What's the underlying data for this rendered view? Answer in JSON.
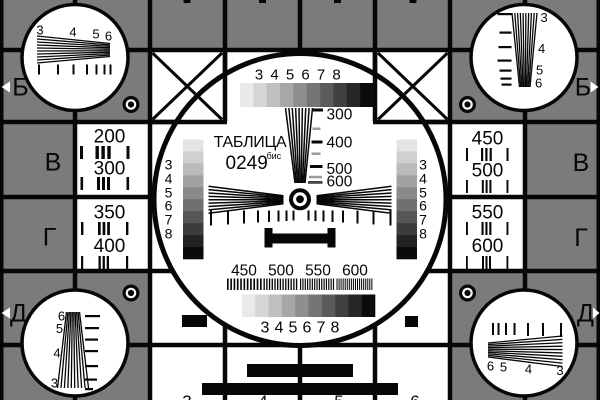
{
  "card": {
    "title": "ТАБЛИЦА",
    "code": "0249",
    "code_sup": "бис"
  },
  "center": {
    "top_scale": [
      "3",
      "4",
      "5",
      "6",
      "7",
      "8"
    ],
    "bottom_scale": [
      "3",
      "4",
      "5",
      "6",
      "7",
      "8"
    ],
    "left_scale": [
      "3",
      "4",
      "5",
      "6",
      "7",
      "8"
    ],
    "right_scale": [
      "3",
      "4",
      "5",
      "6",
      "7",
      "8"
    ],
    "wedge_scale": [
      "300",
      "400",
      "500",
      "600"
    ],
    "burst_scale": [
      "450",
      "500",
      "550",
      "600"
    ]
  },
  "resolution_cells": {
    "left": [
      "200",
      "300",
      "350",
      "400"
    ],
    "right": [
      "450",
      "500",
      "550",
      "600"
    ]
  },
  "edge_markers": {
    "top_left": "Б",
    "top_right": "Б",
    "middle_left": "В",
    "middle_right": "В",
    "lower_left": "Г",
    "lower_right": "Г",
    "bottom_left": "Д",
    "bottom_right": "Д"
  },
  "corner_circles": {
    "top_left": [
      "3",
      "4",
      "5",
      "6"
    ],
    "top_right": [
      "3",
      "4",
      "5",
      "6"
    ],
    "bottom_left": [
      "6",
      "5",
      "4",
      "3"
    ],
    "bottom_right": [
      "6",
      "5",
      "4",
      "3"
    ]
  },
  "bottom_edge_digits": [
    "3",
    "4",
    "5",
    "6"
  ],
  "colors": {
    "field_gray": "#7b7b7b",
    "line_black": "#070707",
    "white": "#ffffff",
    "tick_gray": "#9a9a9a",
    "tick_dark": "#454545",
    "grayscale_steps": [
      "#e9e9e9",
      "#d5d5d5",
      "#bfbfbf",
      "#a7a7a7",
      "#8f8f8f",
      "#757575",
      "#5b5b5b",
      "#414141",
      "#272727",
      "#0b0b0b"
    ],
    "staircase_steps": [
      "#e4e4e4",
      "#d0d0d0",
      "#bababa",
      "#a2a2a2",
      "#8a8a8a",
      "#707070",
      "#565656",
      "#3c3c3c",
      "#222222",
      "#090909"
    ]
  }
}
